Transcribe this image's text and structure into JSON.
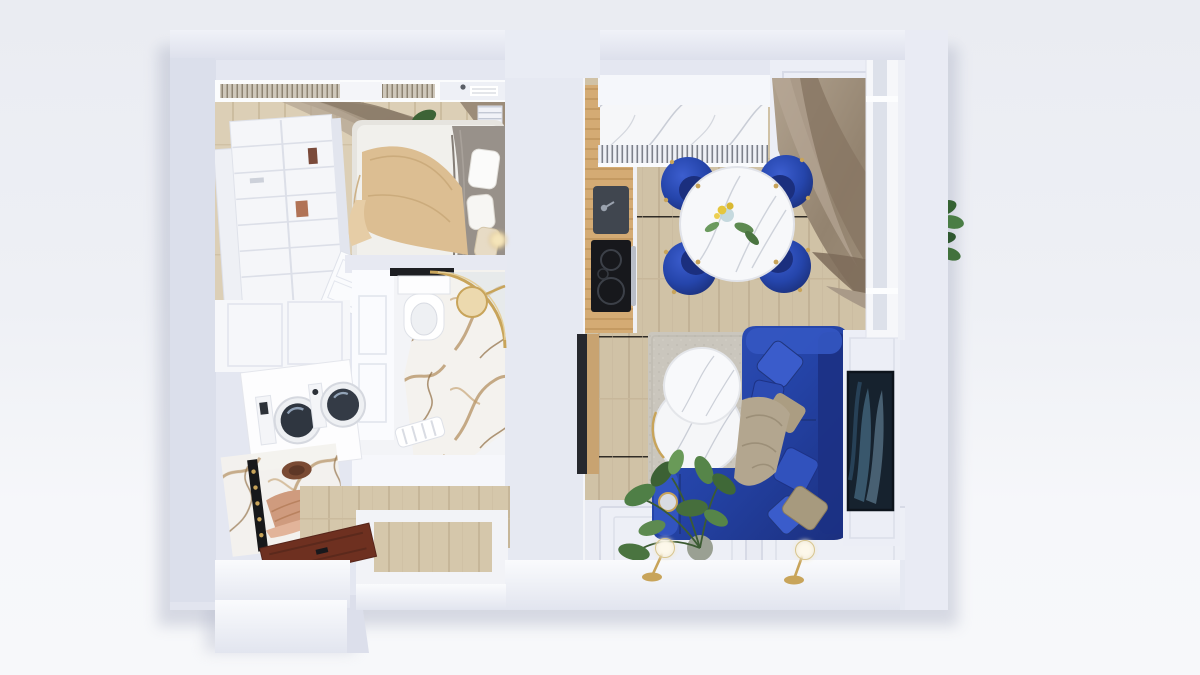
{
  "scene": {
    "title": "Apartment 3D floor plan render",
    "type": "top-down 3d architectural visualization",
    "style": "white walls, light oak floors, royal blue velvet furniture, gold accents, marble surfaces",
    "rooms": [
      {
        "name": "bedroom",
        "label": "Bedroom",
        "floor": "light oak parquet",
        "furniture": [
          "open shelving wardrobe",
          "double bed with beige blanket and grey throw",
          "taupe curtains on top window",
          "white radiator",
          "hanging green plant",
          "white interior door"
        ]
      },
      {
        "name": "bathroom",
        "label": "Bathroom",
        "floor": "white and gold-veined marble tile",
        "furniture": [
          "wall-hung toilet with black shelf",
          "corner shower with curved gold glass frame",
          "round gold rain shower head",
          "white ribbed bath mat",
          "white panelled walls"
        ]
      },
      {
        "name": "hallway-laundry",
        "label": "Hallway / Laundry",
        "floor": "light oak parquet",
        "furniture": [
          "white built-in cabinets",
          "stacked washer and dryer",
          "gold-veined marble coat niche with black hook rail",
          "copper coat and brown hat",
          "dark mahogany front door",
          "white intercom keypad"
        ]
      },
      {
        "name": "kitchen-dining",
        "label": "Kitchen / Dining",
        "floor": "light oak parquet",
        "furniture": [
          "oak kitchen counter",
          "dark undermount sink",
          "black induction cooktop with oven",
          "white upper cabinets",
          "grey-veined marble backsplash",
          "white slatted radiator grille",
          "brass ceiling spot lamp",
          "round white marble dining table with gold feet",
          "4 royal blue velvet tub chairs with gold legs",
          "yellow flowers in vase",
          "taupe drape curtain",
          "balcony window"
        ]
      },
      {
        "name": "living-room",
        "label": "Living room",
        "floor": "light oak parquet with white panelled lower wall",
        "furniture": [
          "royal blue L-shaped velvet sofa",
          "blue velvet cushions",
          "gold sequin cushions",
          "taupe throw blanket",
          "two round white marble nesting coffee tables with gold rims",
          "grey-beige rug",
          "dark abstract wall art / TV on panelled wall",
          "monstera plant in pot",
          "small round gold mirror",
          "two brass globe wall lamps"
        ]
      }
    ],
    "exterior": [
      "thick lavender-white outer walls",
      "bottom-left entry vestibule protrusion",
      "green plant leaves outside right balcony wall"
    ],
    "palette": {
      "background_top": "#eaecf2",
      "background_bottom": "#f7f8fa",
      "wall_face": "#e5e8f1",
      "wall_shadow": "#d6dae7",
      "wall_highlight": "#f3f4f9",
      "wood_floor": "#d5c7ab",
      "wood_floor_light": "#dccfb8",
      "counter_oak": "#d4ab74",
      "royal_blue": "#2646aa",
      "royal_blue_light": "#3a5ccb",
      "royal_blue_dark": "#16245f",
      "gold_brass": "#c8a45a",
      "taupe_curtain": "#9a8a78",
      "taupe_pillow": "#ab9d82",
      "marble_white": "#f6f7f9",
      "marble_gray_vein": "#c9cdd6",
      "marble_gold_vein": "#b08a58",
      "rug": "#cac6bd",
      "front_door": "#6e3020",
      "appliance_dark": "#2f3640",
      "art_navy": "#16222e",
      "plant_green": "#4f7f46"
    }
  }
}
